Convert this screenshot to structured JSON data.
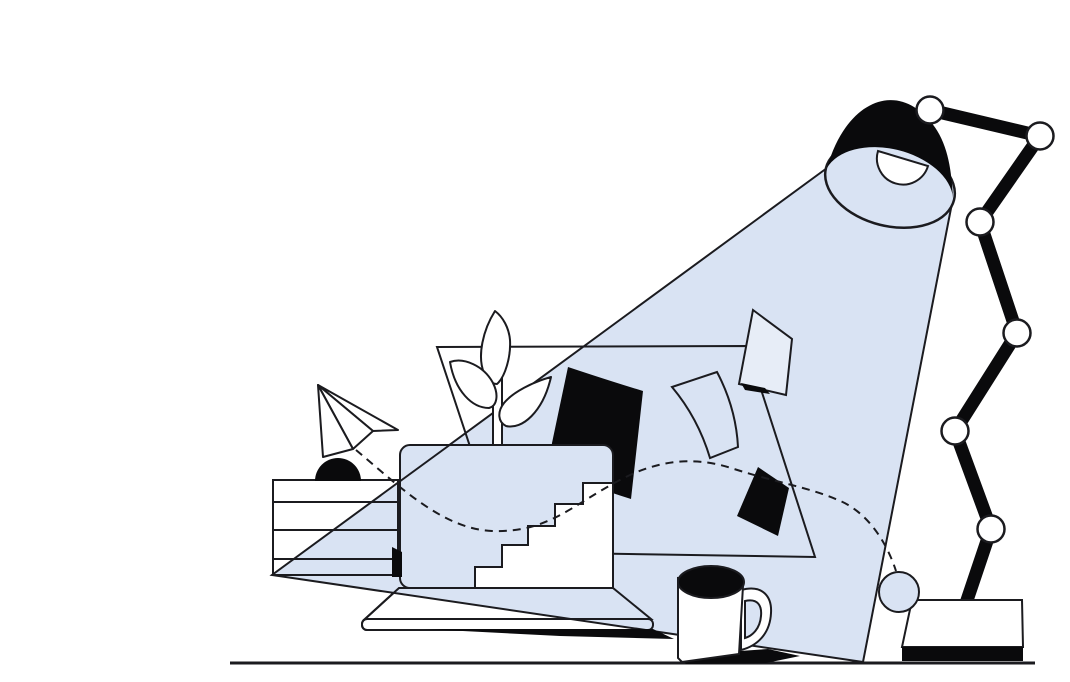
{
  "canvas": {
    "width": 1070,
    "height": 682,
    "background": "#ffffff"
  },
  "palette": {
    "ink": "#1b1b1f",
    "fill_black": "#0a0a0c",
    "beam_blue": "#d9e3f3",
    "paper_soft": "#e7edf7",
    "white": "#ffffff"
  },
  "scene": {
    "description": "Flat line-art illustration of a desk lamp shining a blue cone of light over a creative workspace: laptop with staircase, plant, flying papers, paper airplane, striped box and coffee mug",
    "desk_lamp": {
      "state": "on",
      "joint_count": 6,
      "shade": "black dome",
      "bulb": "white half-dome",
      "base": "white slab with black plinth"
    },
    "light_beam": {
      "shape": "cone",
      "color": "#d9e3f3",
      "origin": "lamp shade opening",
      "reaches": "floor at lower left"
    },
    "laptop": {
      "screen_color": "#d9e3f3",
      "keyboard_color": "#ffffff",
      "open": true
    },
    "staircase": {
      "steps": 5,
      "color": "#ffffff",
      "location": "rising across laptop screen"
    },
    "striped_box": {
      "stripe_lines": 3,
      "color": "#ffffff",
      "topper": "black half-dome"
    },
    "plant": {
      "leaves": 3,
      "color": "#ffffff"
    },
    "paper_airplane": {
      "color": "#ffffff",
      "panels": 3
    },
    "papers": {
      "large_black": 1,
      "small_black": 1,
      "white_outline": 1,
      "white_filled": 1
    },
    "coffee_mug": {
      "body": "#ffffff",
      "coffee": "#0a0a0c",
      "handle": "right"
    },
    "dashed_path": {
      "style": "dashed curve",
      "from": "paper airplane",
      "to": "blue ball at lamp base"
    },
    "blue_ball": {
      "color": "#d9e3f3"
    },
    "floor_line": {
      "from_x": 230,
      "to_x": 1035
    }
  }
}
